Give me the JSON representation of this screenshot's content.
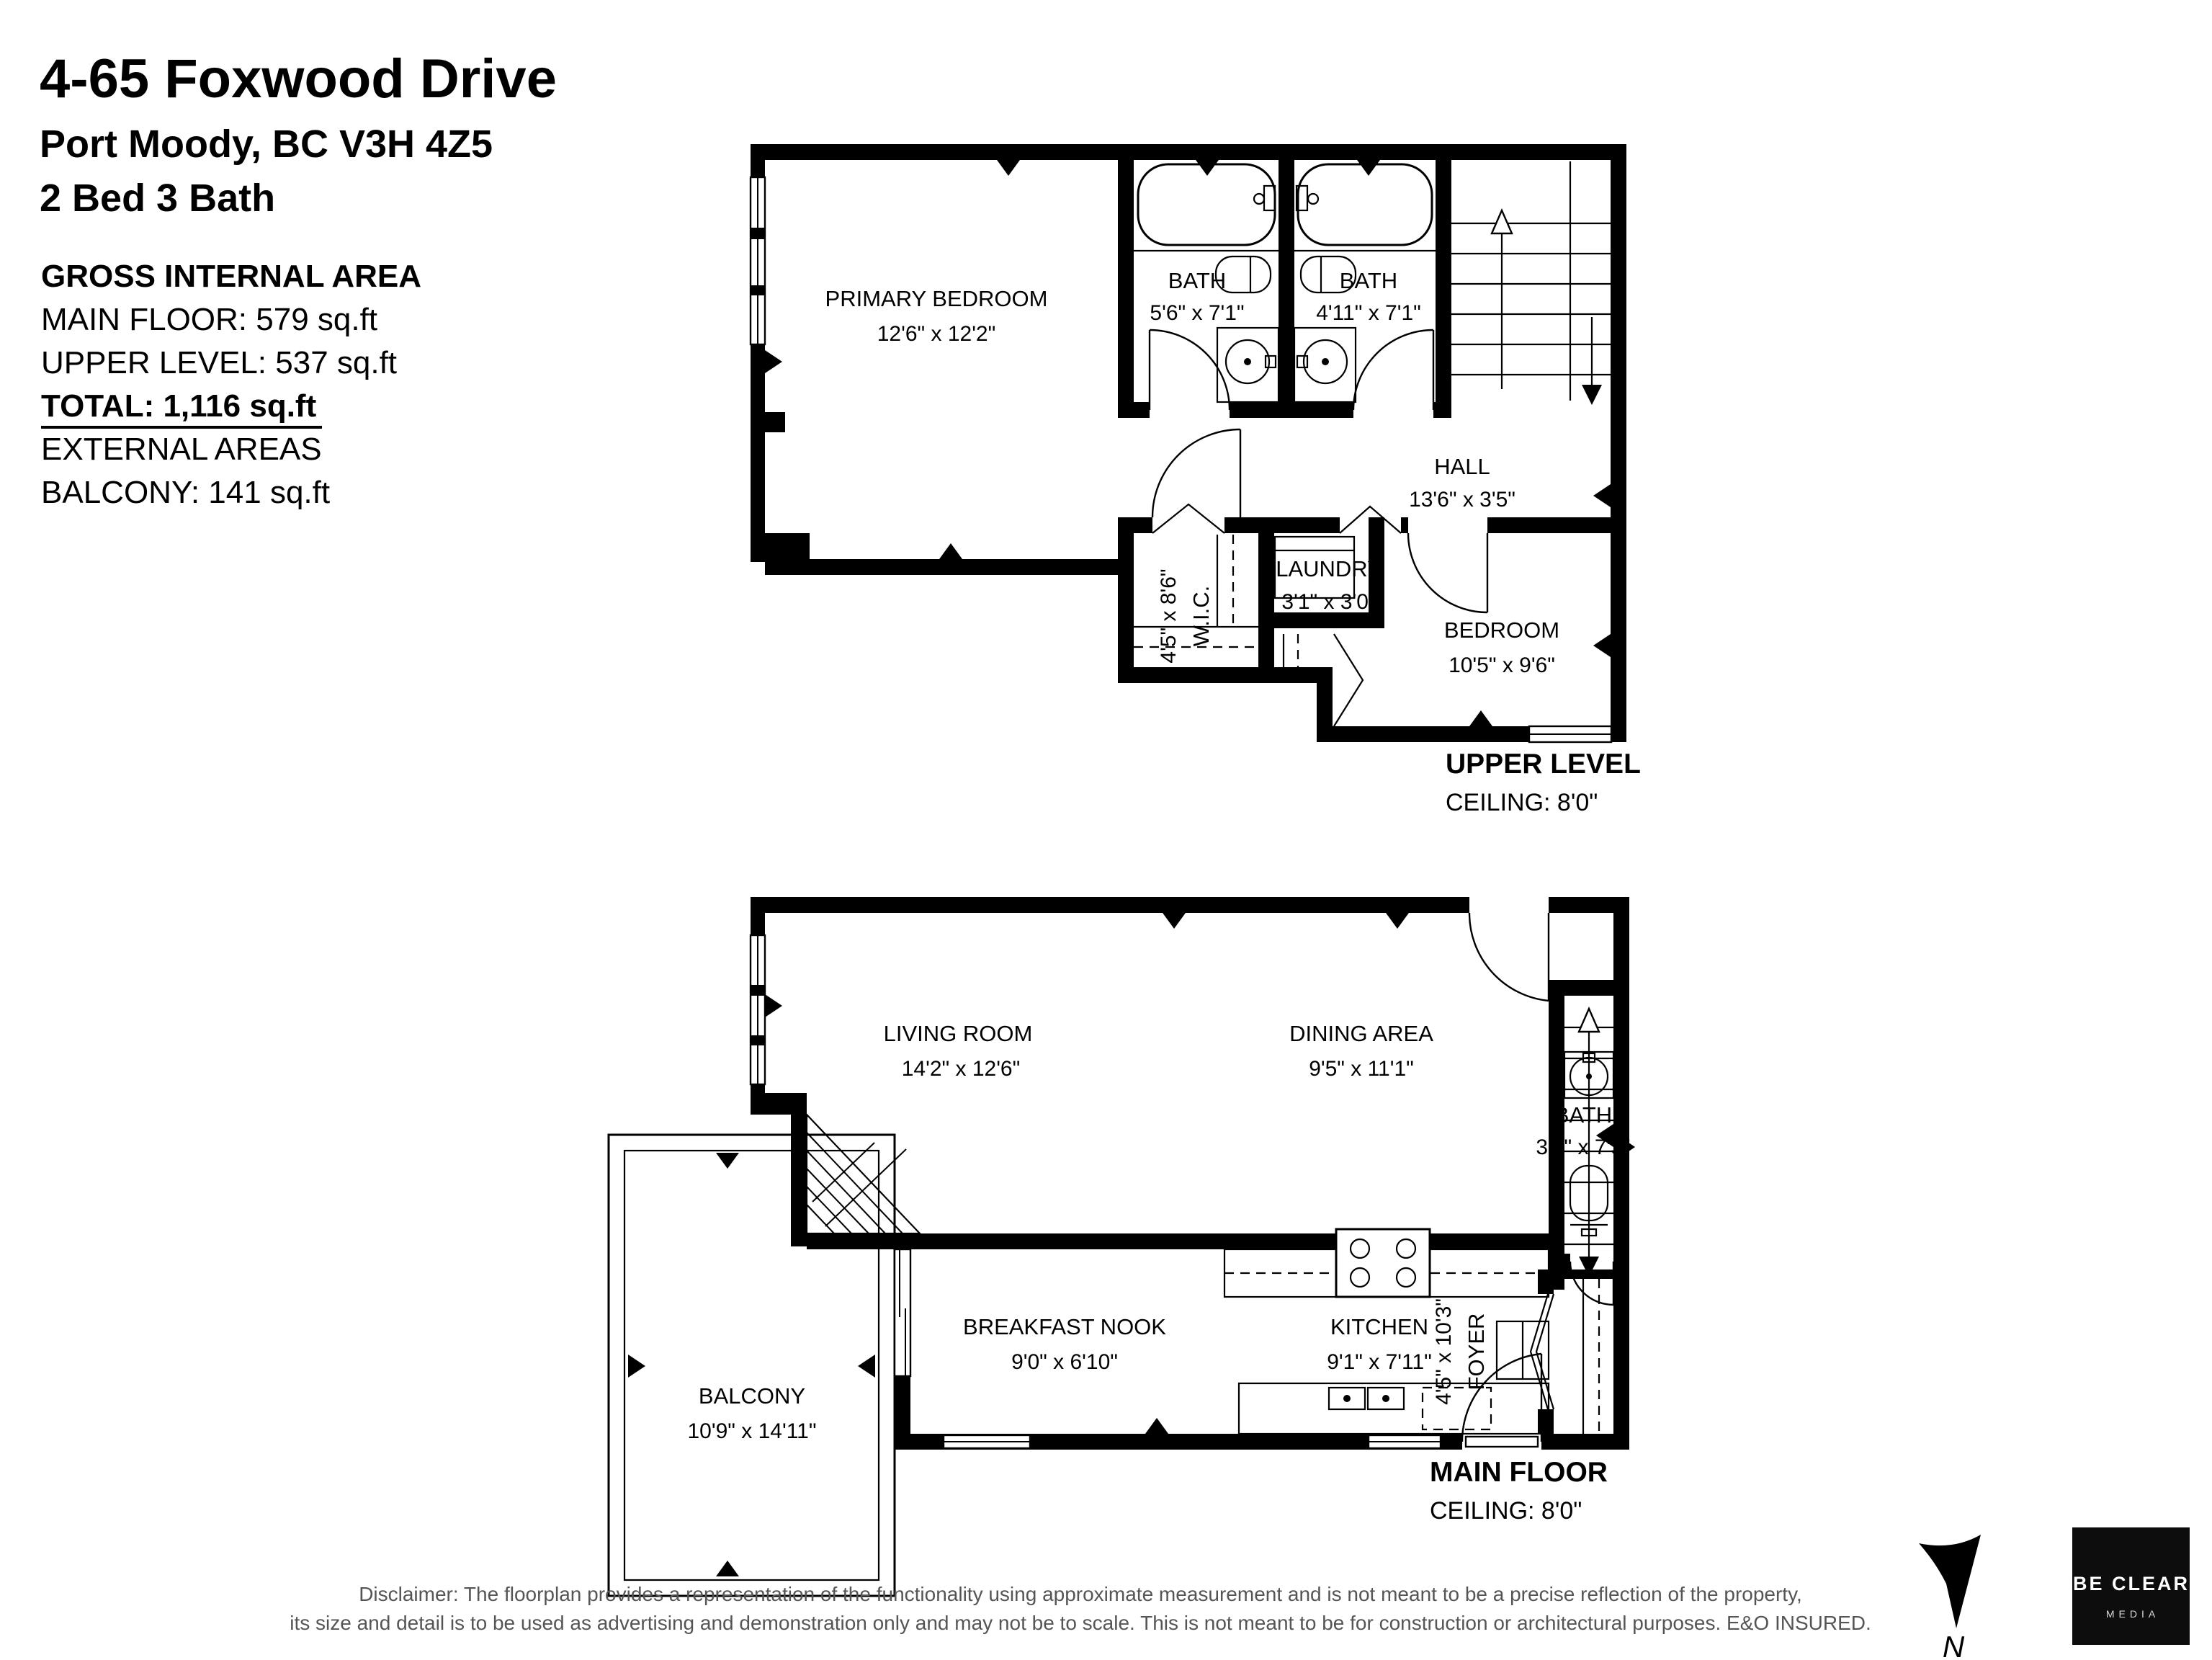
{
  "header": {
    "address_line1": "4-65 Foxwood Drive",
    "address_line2": "Port Moody, BC V3H 4Z5",
    "beds_baths": "2 Bed 3 Bath"
  },
  "areas": {
    "heading": "GROSS INTERNAL AREA",
    "main_floor": "MAIN FLOOR: 579 sq.ft",
    "upper_level": "UPPER LEVEL: 537 sq.ft",
    "total": "TOTAL: 1,116 sq.ft",
    "external_heading": "EXTERNAL AREAS",
    "balcony": "BALCONY: 141 sq.ft"
  },
  "upper_level": {
    "label": "UPPER LEVEL",
    "ceiling": "CEILING: 8'0\"",
    "rooms": {
      "primary": {
        "name": "PRIMARY BEDROOM",
        "dims": "12'6\" x 12'2\""
      },
      "bath_left": {
        "name": "BATH",
        "dims": "5'6\" x 7'1\""
      },
      "bath_right": {
        "name": "BATH",
        "dims": "4'11\" x 7'1\""
      },
      "hall": {
        "name": "HALL",
        "dims": "13'6\" x 3'5\""
      },
      "laundry": {
        "name": "LAUNDRY",
        "dims": "3'1\" x 3'0\""
      },
      "wic": {
        "name": "W.I.C.",
        "dims": "4'5\" x 8'6\""
      },
      "bedroom": {
        "name": "BEDROOM",
        "dims": "10'5\" x 9'6\""
      }
    }
  },
  "main_floor": {
    "label": "MAIN FLOOR",
    "ceiling": "CEILING: 8'0\"",
    "rooms": {
      "living": {
        "name": "LIVING ROOM",
        "dims": "14'2\" x 12'6\""
      },
      "dining": {
        "name": "DINING AREA",
        "dims": "9'5\" x 11'1\""
      },
      "bath": {
        "name": "BATH",
        "dims": "3'2\" x 7'3\""
      },
      "foyer": {
        "name": "FOYER",
        "dims": "4'5\" x 10'3\""
      },
      "kitchen": {
        "name": "KITCHEN",
        "dims": "9'1\" x 7'11\""
      },
      "nook": {
        "name": "BREAKFAST NOOK",
        "dims": "9'0\" x 6'10\""
      },
      "balcony": {
        "name": "BALCONY",
        "dims": "10'9\" x 14'11\""
      }
    }
  },
  "footer": {
    "disclaimer_line1": "Disclaimer: The floorplan provides a representation of the functionality using approximate measurement and is not meant to be a precise reflection of the property,",
    "disclaimer_line2": "its size and detail is to be used as advertising and demonstration only and may not be to scale. This is not meant to be for construction or architectural purposes. E&O INSURED.",
    "north_label": "N"
  },
  "logo": {
    "name": "BE CLEAR",
    "tagline": "MEDIA"
  },
  "colors": {
    "wall": "#000000",
    "disclaimer": "#555555",
    "logo_bg": "#0d0d0d"
  }
}
